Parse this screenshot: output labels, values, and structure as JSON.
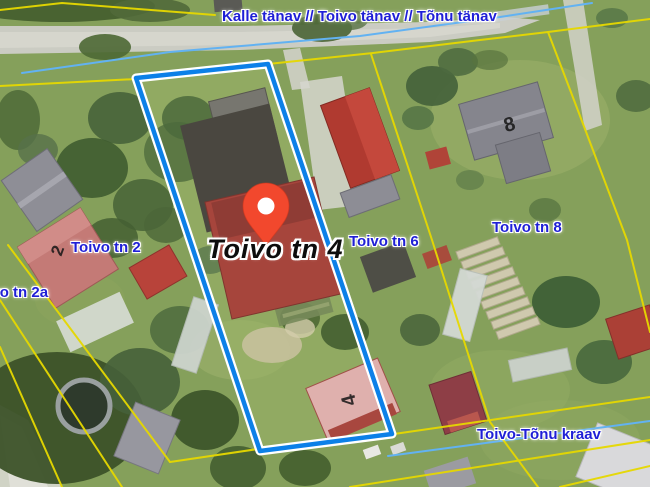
{
  "map": {
    "street_label": "Kalle tänav // Toivo tänav // Tõnu tänav",
    "selected_parcel": {
      "label": "Toivo tn 4"
    },
    "parcel_labels": [
      {
        "id": "tn2",
        "text": "Toivo tn 2"
      },
      {
        "id": "tn2a",
        "text": "Toivo tn 2a"
      },
      {
        "id": "tn6",
        "text": "Toivo tn 6"
      },
      {
        "id": "tn8",
        "text": "Toivo tn 8"
      }
    ],
    "ditch_label": "Toivo-Tõnu kraav",
    "house_numbers": [
      {
        "id": "h2",
        "text": "2"
      },
      {
        "id": "h4",
        "text": "4"
      },
      {
        "id": "h8",
        "text": "8"
      }
    ],
    "colors": {
      "cadastral_line": "#e6d800",
      "stream_line": "#62b2f2",
      "selected_parcel_outline": "#0c80e8",
      "selected_parcel_casing": "#ffffff",
      "pin_fill": "#f2482d",
      "pin_stroke": "#d2371d",
      "label_text": "#1f1fd6",
      "label_halo": "#ffffff",
      "selected_label_text": "#0d0d0d"
    }
  }
}
